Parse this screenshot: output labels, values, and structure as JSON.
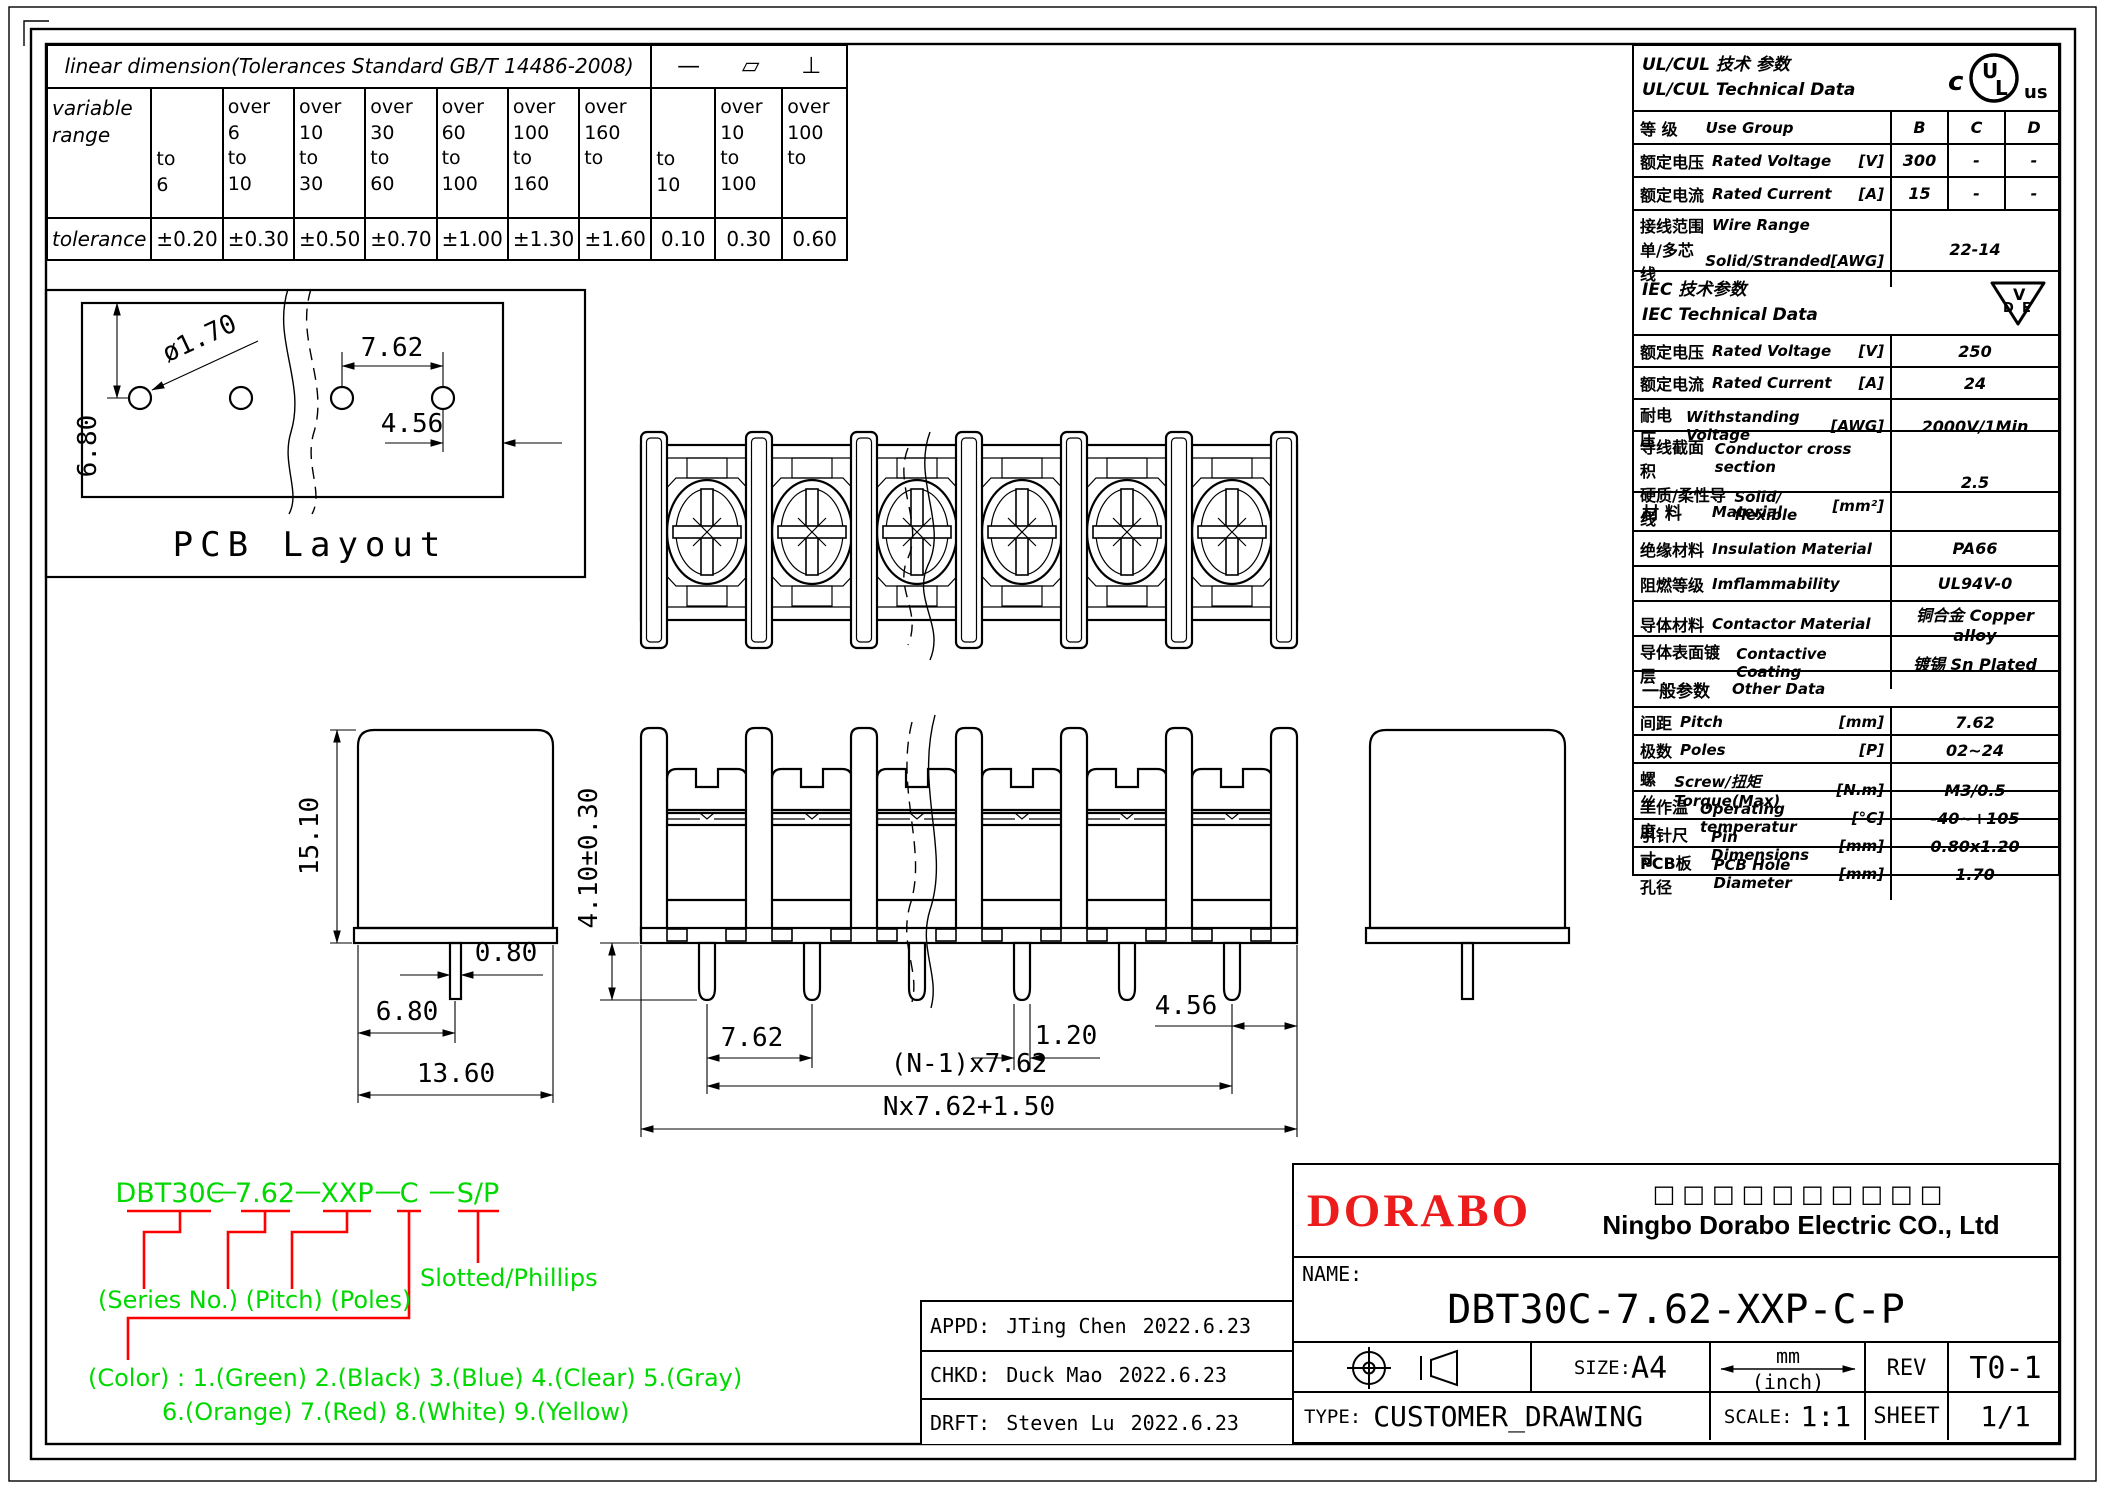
{
  "colors": {
    "green": "#00d900",
    "red": "#ff0000",
    "logo_red": "#ed1c1c"
  },
  "tolerance_table": {
    "title": "linear dimension(Tolerances Standard GB/T 14486-2008)",
    "symbols": [
      "—",
      "▱",
      "⊥"
    ],
    "row_header_top": [
      "variable",
      "range"
    ],
    "row_header_bottom": "tolerance",
    "columns": [
      {
        "range": [
          "to",
          "6"
        ],
        "tol": "±0.20"
      },
      {
        "range": [
          "over",
          "6",
          "to",
          "10"
        ],
        "tol": "±0.30"
      },
      {
        "range": [
          "over",
          "10",
          "to",
          "30"
        ],
        "tol": "±0.50"
      },
      {
        "range": [
          "over",
          "30",
          "to",
          "60"
        ],
        "tol": "±0.70"
      },
      {
        "range": [
          "over",
          "60",
          "to",
          "100"
        ],
        "tol": "±1.00"
      },
      {
        "range": [
          "over",
          "100",
          "to",
          "160"
        ],
        "tol": "±1.30"
      },
      {
        "range": [
          "over",
          "160",
          "to"
        ],
        "tol": "±1.60"
      },
      {
        "range": [
          "to",
          "10"
        ],
        "tol": "0.10"
      },
      {
        "range": [
          "over",
          "10",
          "to",
          "100"
        ],
        "tol": "0.30"
      },
      {
        "range": [
          "over",
          "100",
          "to"
        ],
        "tol": "0.60"
      }
    ]
  },
  "spec_table": {
    "ul": {
      "line1": "UL/CUL   技术 参数",
      "line2": "UL/CUL   Technical Data",
      "group_zh": "等 级",
      "group_en": "Use Group",
      "group_cols": [
        "B",
        "C",
        "D"
      ],
      "rows": [
        {
          "zh": "额定电压",
          "en": "Rated Voltage",
          "unit": "[V]",
          "vals": [
            "300",
            "-",
            "-"
          ]
        },
        {
          "zh": "额定电流",
          "en": "Rated Current",
          "unit": "[A]",
          "vals": [
            "15",
            "-",
            "-"
          ]
        }
      ],
      "wire_zh1": "接线范围",
      "wire_en1": "Wire Range",
      "wire_zh2": "单/多芯线",
      "wire_en2": "Solid/Stranded",
      "wire_unit": "[AWG]",
      "wire_value": "22-14"
    },
    "iec": {
      "line1": "IEC  技术参数",
      "line2": "IEC  Technical Data",
      "rows": [
        {
          "zh": "额定电压",
          "en": "Rated Voltage",
          "unit": "[V]",
          "value": "250"
        },
        {
          "zh": "额定电流",
          "en": "Rated Current",
          "unit": "[A]",
          "value": "24"
        },
        {
          "zh": "耐电压",
          "en": "Withstanding Voltage",
          "unit": "[AWG]",
          "value": "2000V/1Min"
        }
      ],
      "cond_zh1": "导线截面积",
      "cond_en1": "Conductor cross section",
      "cond_zh2": "硬质/柔性导线",
      "cond_en2": "Solid/ flexible",
      "cond_unit": "[mm²]",
      "cond_value": "2.5"
    },
    "material": {
      "title_zh": "材 料",
      "title_en": "Material",
      "rows": [
        {
          "zh": "绝缘材料",
          "en": "Insulation Material",
          "value": "PA66"
        },
        {
          "zh": "阻燃等级",
          "en": "Imflammability",
          "value": "UL94V-0"
        },
        {
          "zh": "导体材料",
          "en": "Contactor Material",
          "value": "铜合金 Copper alloy"
        },
        {
          "zh": "导体表面镀层",
          "en": "Contactive Coating",
          "value": "镀锡 Sn Plated"
        }
      ]
    },
    "other": {
      "title_zh": "一般参数",
      "title_en": "Other Data",
      "rows": [
        {
          "zh": "间距",
          "en": "Pitch",
          "unit": "[mm]",
          "value": "7.62"
        },
        {
          "zh": "极数",
          "en": "Poles",
          "unit": "[P]",
          "value": "02~24"
        },
        {
          "zh": "螺丝",
          "en": "Screw/扭矩 Torque(Max)",
          "unit": "[N.m]",
          "value": "M3/0.5"
        },
        {
          "zh": "工作温度",
          "en": "Operating temperatur",
          "unit": "[°C]",
          "value": "-40~+105"
        },
        {
          "zh": "引针尺寸",
          "en": "Pin Dimensions",
          "unit": "[mm]",
          "value": "0.80x1.20"
        },
        {
          "zh": "PCB板孔径",
          "en": "PCB Hole Diameter",
          "unit": "[mm]",
          "value": "1.70"
        }
      ]
    }
  },
  "drawing": {
    "pcb": {
      "caption": "PCB  Layout",
      "hole_dia": "ø1.70",
      "hole_offset": "6.80",
      "hole_pitch": "7.62",
      "hole_edge": "4.56"
    },
    "side": {
      "height": "15.10",
      "pin_width": "0.80",
      "pin_offset": "6.80",
      "body_width": "13.60"
    },
    "front": {
      "pin_length": "4.10±0.30",
      "pitch": "7.62",
      "pin_thickness": "1.20",
      "end_margin": "4.56",
      "pin_span": "(N-1)x7.62",
      "total_length": "Nx7.62+1.50"
    }
  },
  "part_code": {
    "series": "DBT30C",
    "dash": "—",
    "pitch": "7.62",
    "poles": "XXP",
    "color": "C",
    "drive": "S/P",
    "labels": {
      "series_pitch_poles": "(Series No.) (Pitch) (Poles)",
      "drive": "Slotted/Phillips",
      "color_line1": "(Color) : 1.(Green)  2.(Black)  3.(Blue)  4.(Clear)  5.(Gray)",
      "color_line2": "6.(Orange)  7.(Red)  8.(White)  9.(Yellow)"
    }
  },
  "title_block": {
    "logo": "DORABO",
    "company_cn": "□□□□□□□□□□",
    "company_en": "Ningbo Dorabo Electric CO., Ltd",
    "name_label": "NAME:",
    "part_number": "DBT30C-7.62-XXP-C-P",
    "size_label": "SIZE:",
    "size": "A4",
    "unit_top": "mm",
    "unit_bottom": "(inch)",
    "rev_label": "REV",
    "rev": "T0-1",
    "type_label": "TYPE:",
    "type": "CUSTOMER_DRAWING",
    "scale_label": "SCALE:",
    "scale": "1:1",
    "sheet_label": "SHEET",
    "sheet": "1/1",
    "approvals": [
      {
        "role": "APPD:",
        "name": "JTing Chen",
        "date": "2022.6.23"
      },
      {
        "role": "CHKD:",
        "name": "Duck Mao",
        "date": "2022.6.23"
      },
      {
        "role": "DRFT:",
        "name": "Steven Lu",
        "date": "2022.6.23"
      }
    ]
  }
}
